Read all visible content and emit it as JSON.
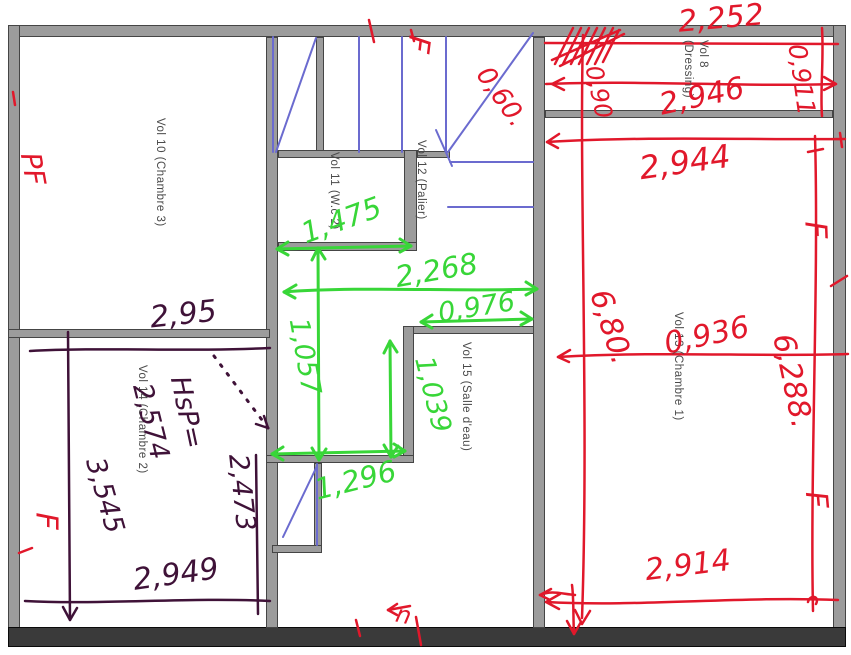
{
  "colors": {
    "wall_gray": "#9c9c9c",
    "wall_dark": "#3a3a3a",
    "stair_blue": "#6b6bcf",
    "ink_red": "#e1182b",
    "ink_green": "#38d638",
    "ink_purple": "#3f1238",
    "label_gray": "#4a4a4a"
  },
  "rooms": {
    "vol10": "Vol 10 (Chambre 3)",
    "vol11": "Vol 11 (W.c 2)",
    "vol12": "Vol 12 (Palier)",
    "vol8": "Vol 8 (Dressing)",
    "vol13": "Vol 13 (Chambre 1)",
    "vol14": "Vol 14 (Chambre 2)",
    "vol15": "Vol 15 (Salle d'eau)"
  },
  "annotations": {
    "red": {
      "m2252": "2,252",
      "m0911": "0,911",
      "m2946": "2,946",
      "m090": "0,90",
      "m060": "0,60.",
      "m2944": "2,944",
      "m680": "6,80.",
      "m0936": "0,936",
      "m6288": "6,288.",
      "m2914": "2,914",
      "f": "F",
      "pf": "PF",
      "n": "n"
    },
    "green": {
      "m1475": "1,475",
      "m2268": "2,268",
      "m0976": "0,976",
      "m1057": "1,057",
      "m1039": "1,039",
      "m1296": "1,296"
    },
    "purple": {
      "m295": "2,95",
      "hsp": "HsP=",
      "m2574": "2,574",
      "m3545": "3,545",
      "m2473": "2,473",
      "m2949": "2,949"
    }
  }
}
